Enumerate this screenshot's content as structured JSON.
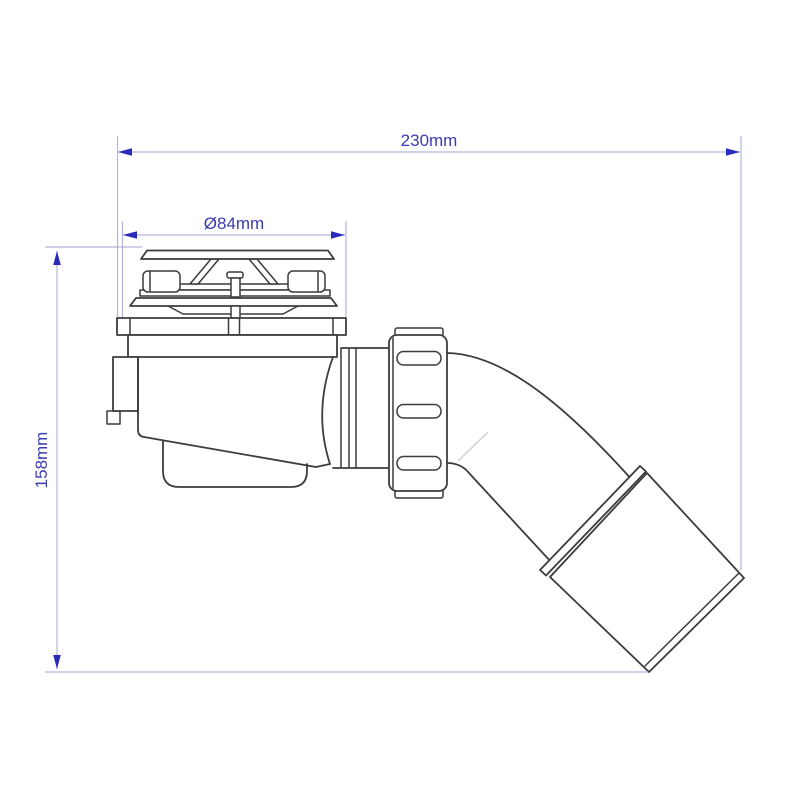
{
  "drawing": {
    "type": "technical-dimension-drawing",
    "subject": "shower-trap-with-45-degree-outlet",
    "dimensions": [
      {
        "id": "overall-width",
        "label": "230mm",
        "orientation": "horizontal",
        "position": "top"
      },
      {
        "id": "flange-diameter",
        "label": "Ø84mm",
        "orientation": "horizontal",
        "position": "above-cap"
      },
      {
        "id": "overall-height",
        "label": "158mm",
        "orientation": "vertical",
        "position": "left"
      }
    ],
    "parts": [
      "cap-disc",
      "cap-webs",
      "clip-tabs",
      "strainer-plate",
      "flange-disc",
      "tray-flange-bar",
      "trap-body",
      "sump",
      "outlet-cylinder",
      "compression-nut",
      "elbow-bend",
      "socket-collar",
      "outlet-pipe"
    ],
    "colors": {
      "background": "#ffffff",
      "line": "#3c3c3c",
      "dimension_line": "#b3b3da",
      "dimension_arrow": "#2a2ab8",
      "dimension_text": "#3b3bb0",
      "accent_line": "#cfcfcf"
    }
  }
}
